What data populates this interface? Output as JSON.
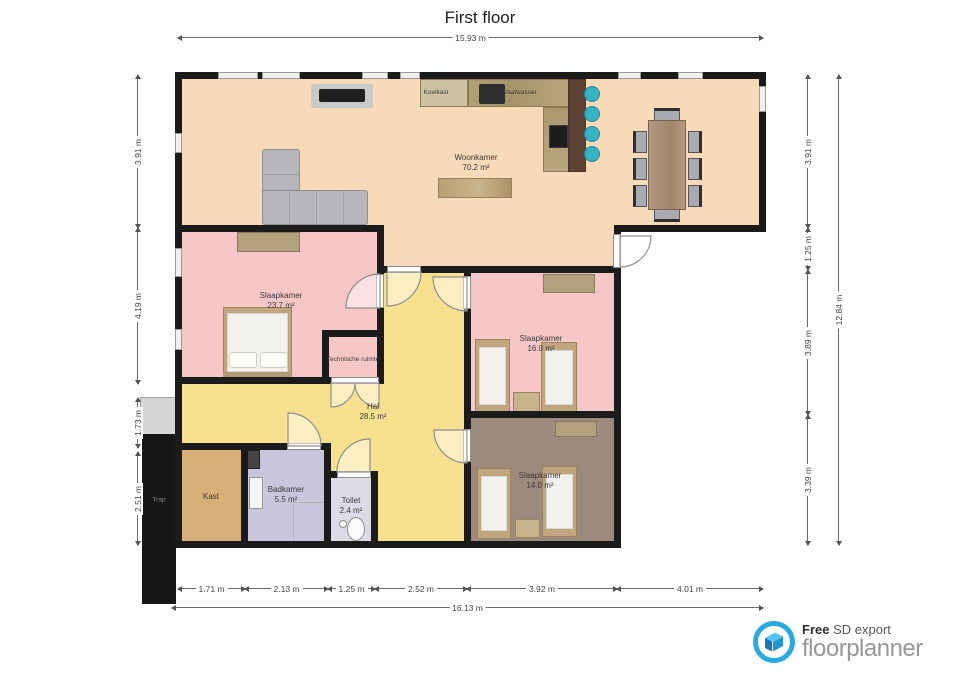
{
  "title": "First floor",
  "dimensions": {
    "top": "15.93 m",
    "bottom_total": "16.13 m",
    "right_total": "12.84 m",
    "bottom_segments": [
      "1.71 m",
      "2.13 m",
      "1.25 m",
      "2.52 m",
      "3.92 m",
      "4.01 m"
    ],
    "left_segments": [
      "3.91 m",
      "4.19 m",
      "1.73 m",
      "2.51 m"
    ],
    "right_segments": [
      "3.91 m",
      "1.25 m",
      "3.89 m",
      "3.39 m"
    ]
  },
  "rooms": {
    "woonkamer": {
      "name": "Woonkamer",
      "area": "70.2 m²"
    },
    "slaapkamer_groot": {
      "name": "Slaapkamer",
      "area": "23.7 m²"
    },
    "slaapkamer_midden": {
      "name": "Slaapkamer",
      "area": "16.0 m²"
    },
    "slaapkamer_klein": {
      "name": "Slaapkamer",
      "area": "14.0 m²"
    },
    "hal": {
      "name": "Hal",
      "area": "28.5 m²"
    },
    "badkamer": {
      "name": "Badkamer",
      "area": "5.5 m²"
    },
    "toilet": {
      "name": "Toilet",
      "area": "2.4 m²"
    },
    "kast": {
      "name": "Kast"
    },
    "technische_ruimte": {
      "name": "Technische ruimte"
    },
    "trap": {
      "name": "Trap"
    }
  },
  "fixtures": {
    "koelkast": "Koelkast",
    "vaatwasser": "Vaatwasser"
  },
  "footer": {
    "free": "Free",
    "export_label": "SD export",
    "brand": "floorplanner"
  },
  "colors": {
    "wall": "#1b1b1b",
    "peach": "#f8d9b8",
    "pink": "#f6c7c7",
    "yellow": "#f7e18f",
    "brown": "#9c8a7c",
    "tan": "#d7b078",
    "lavender": "#c7c6db",
    "lavender_light": "#dcdbe7",
    "stool_teal": "#35b3c3",
    "counter_wood": "#b2a077",
    "bar_wood": "#5d4334",
    "sofa_gray": "#b6b6ba",
    "bed_frame": "#c0a57d",
    "accent_blue": "#29abe2",
    "brand_gray": "#97979c"
  }
}
